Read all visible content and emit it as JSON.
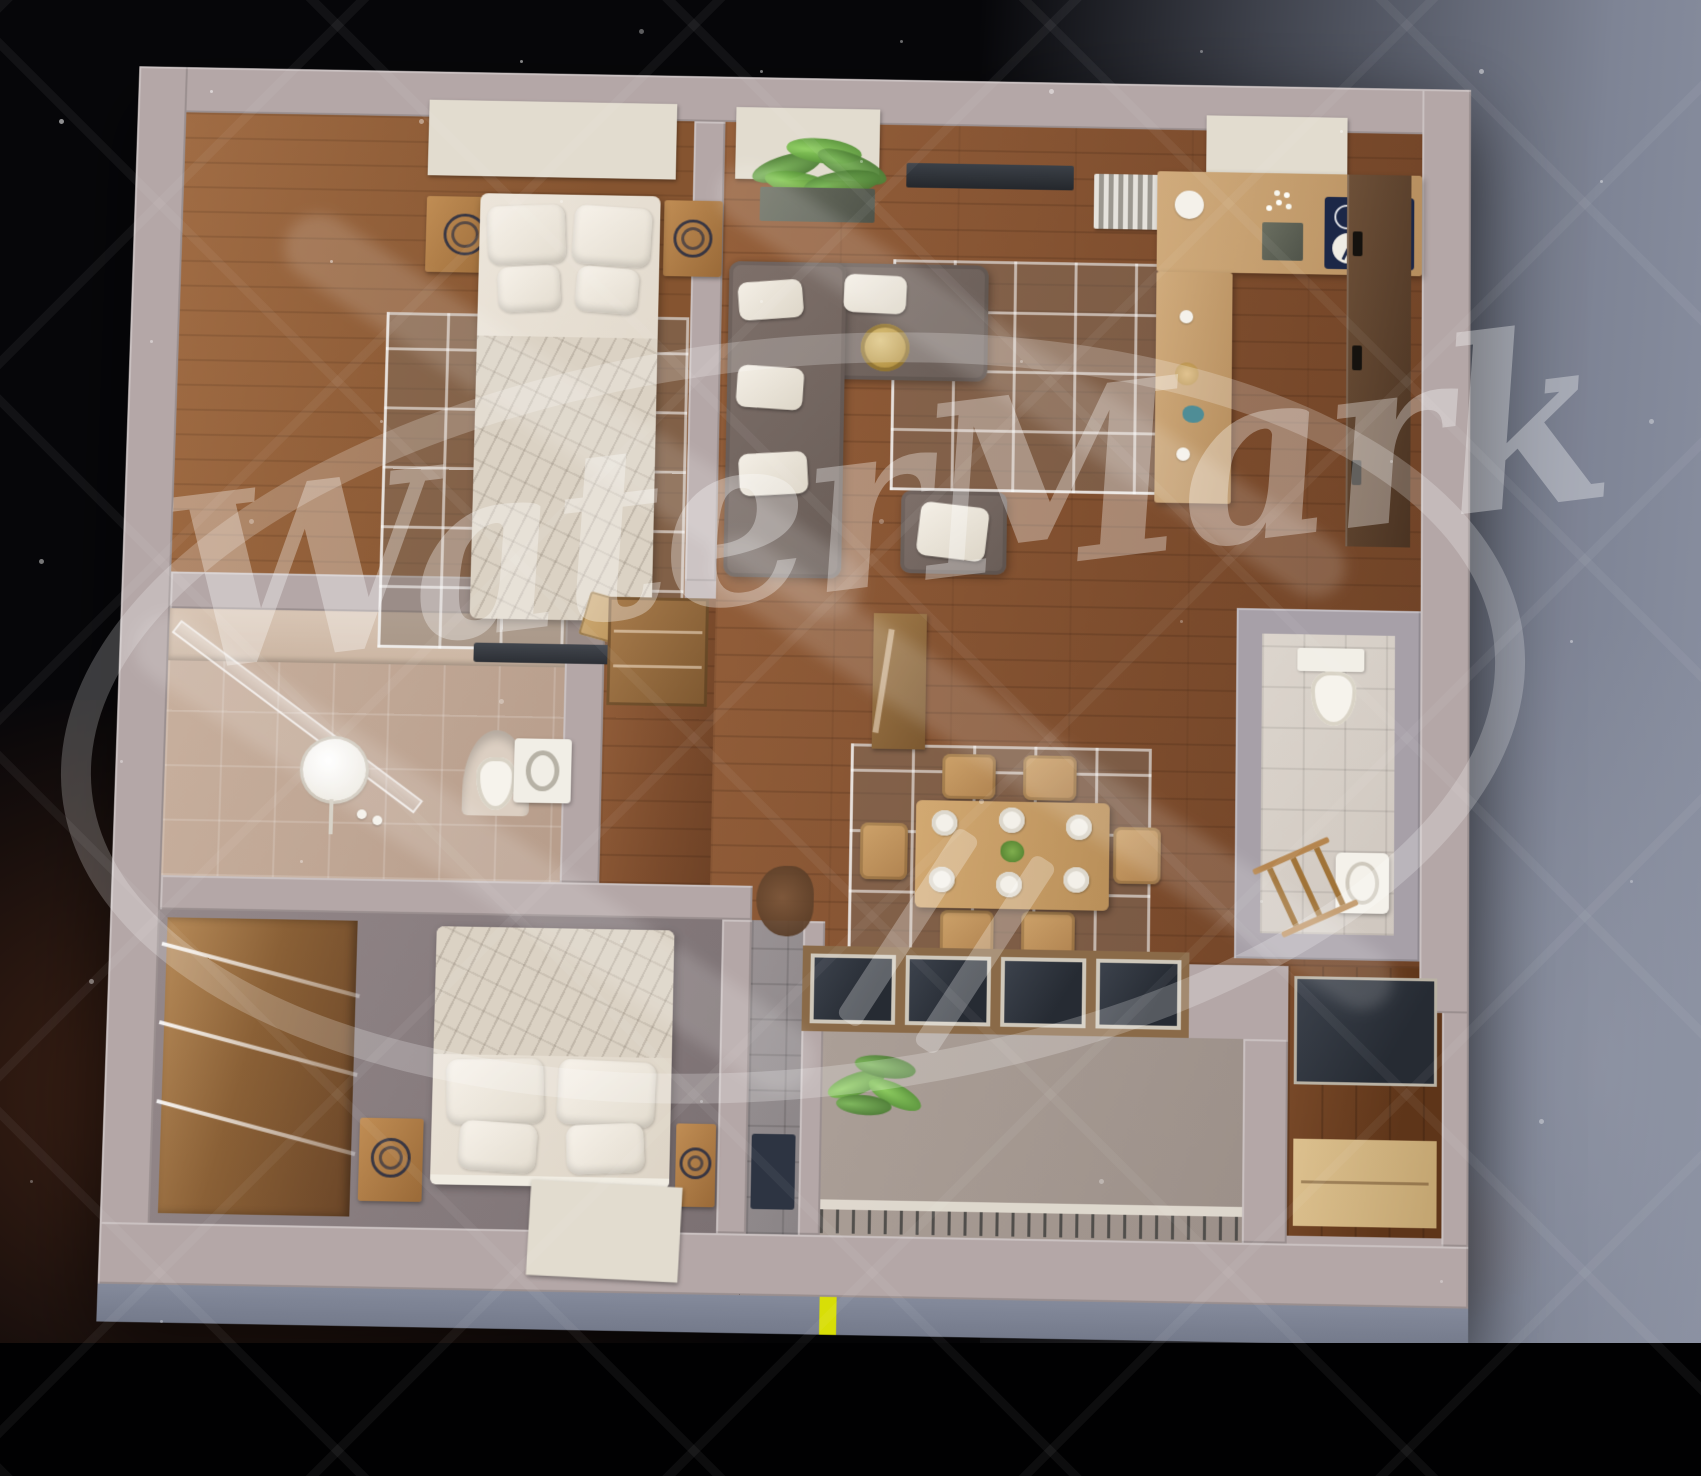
{
  "watermark": {
    "text": "WaterMark",
    "color": "rgba(255,255,255,0.33)",
    "elements": [
      "script-text",
      "ellipse-swoosh-ring",
      "double-slash-tail",
      "diagonal-diamond-hatch"
    ]
  },
  "scene": {
    "description": "Top-down 3D render of a furnished apartment floor plan at night",
    "rooms": [
      {
        "id": "bedroom-1",
        "area": "top-left",
        "furniture": [
          "skylight-window",
          "double-bed",
          "two-pillows",
          "two-cushions",
          "blanket",
          "nightstand-with-clock-left",
          "nightstand-with-clock-right",
          "area-rug",
          "desk",
          "wooden-board"
        ]
      },
      {
        "id": "living-room",
        "area": "top-center",
        "furniture": [
          "skylight-window",
          "potted-palm",
          "tv-console",
          "radiator",
          "corner-sofa",
          "white-cushions",
          "wicker-basket",
          "ottoman",
          "grid-area-rug"
        ]
      },
      {
        "id": "kitchen",
        "area": "top-right",
        "furniture": [
          "skylight-window",
          "l-shaped-counter",
          "island-counter",
          "navy-cooktop",
          "kitchen-clock",
          "tulip-vase",
          "plates",
          "tall-dark-cabinets"
        ]
      },
      {
        "id": "dining-area",
        "area": "center",
        "furniture": [
          "wooden-table",
          "six-chairs",
          "six-plates",
          "green-centerpiece",
          "grid-area-rug",
          "dried-plant"
        ]
      },
      {
        "id": "bathroom",
        "area": "middle-left",
        "furniture": [
          "glass-shower-screen",
          "round-mirror",
          "floor-faucet-set",
          "arched-niche-toilet",
          "washing-machine"
        ]
      },
      {
        "id": "hallway-entry",
        "area": "center-left",
        "furniture": [
          "open-closet",
          "wooden-console",
          "entry-mat",
          "gray-tile-floor"
        ]
      },
      {
        "id": "wc",
        "area": "middle-right",
        "furniture": [
          "toilet-with-cistern",
          "washbasin",
          "leaning-wooden-ladder"
        ]
      },
      {
        "id": "bedroom-2",
        "area": "bottom-left",
        "furniture": [
          "sliding-door-wardrobe",
          "double-bed-sketch-blanket",
          "two-pillows",
          "two-cushions",
          "nightstand-with-clock-left",
          "nightstand-with-clock-right",
          "skylight-window"
        ]
      },
      {
        "id": "balcony",
        "area": "bottom-center",
        "furniture": [
          "glazed-panel-band",
          "potted-palm",
          "concrete-floor",
          "railing-with-slats"
        ]
      },
      {
        "id": "loggia",
        "area": "bottom-right",
        "furniture": [
          "dark-glass-wall",
          "wood-deck",
          "storage-bench"
        ]
      }
    ]
  },
  "palette": {
    "wall": "#b4a7a7",
    "concrete_wall": "#a7a0a8",
    "wood_floor": "#7b4b2c",
    "wood_floor_light": "#a06c44",
    "counter_wood": "#c8a87a",
    "bath_tile": "#c0a794",
    "wc_tile": "#d8d1c9",
    "gray_tile": "#949094",
    "bedroom2_floor": "#8a7f81",
    "balcony_concrete": "#a49a93",
    "facade": "#7b8191",
    "glass_dark": "#2e333c",
    "window_frame": "#e2dccf",
    "sofa": "#74665f",
    "cooktop_navy": "#1c2747",
    "plant_green": "#4f7a38",
    "accent_yellow": "#d8de07",
    "sky_black": "#060609",
    "sky_slate": "#7e8495",
    "sky_nebula_brown": "#7a3e20"
  }
}
